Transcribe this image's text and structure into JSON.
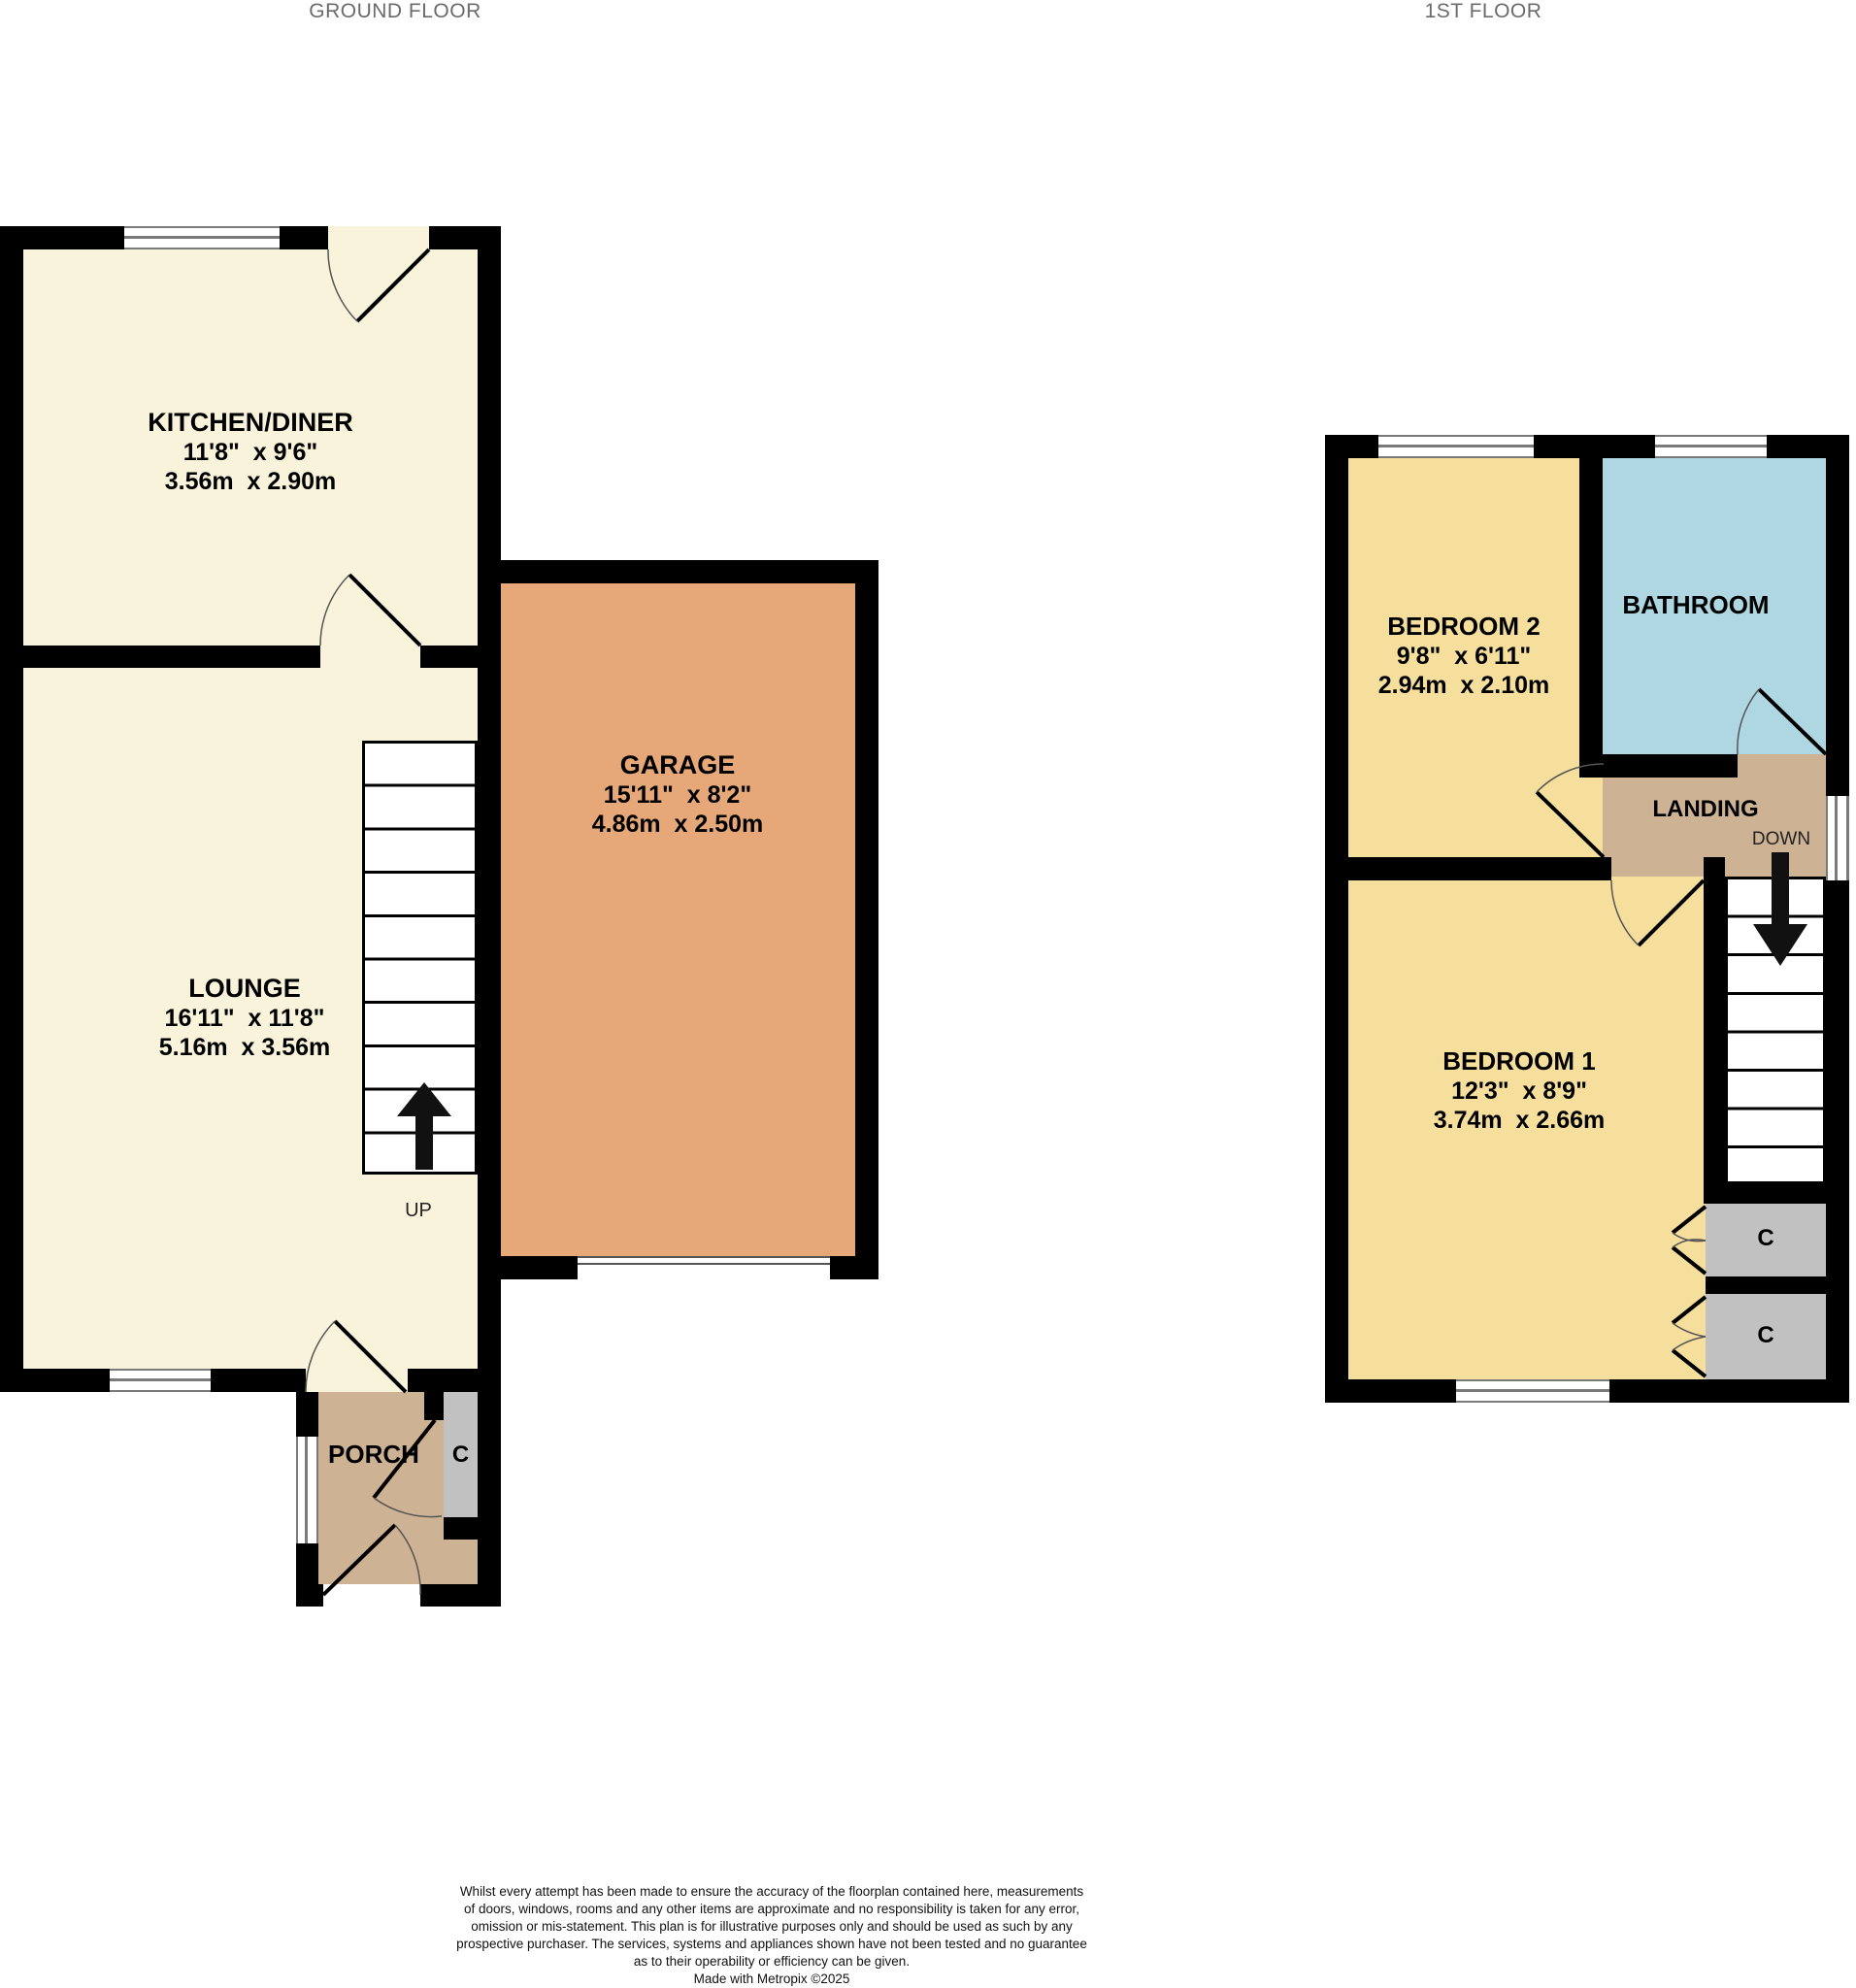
{
  "floors": {
    "ground": {
      "title": "GROUND FLOOR",
      "rooms": {
        "kitchen": {
          "name": "KITCHEN/DINER",
          "imperial": "11'8\"  x 9'6\"",
          "metric": "3.56m  x 2.90m"
        },
        "lounge": {
          "name": "LOUNGE",
          "imperial": "16'11\"  x 11'8\"",
          "metric": "5.16m  x 3.56m"
        },
        "garage": {
          "name": "GARAGE",
          "imperial": "15'11\"  x 8'2\"",
          "metric": "4.86m  x 2.50m"
        },
        "porch": {
          "name": "PORCH"
        },
        "cupboard": {
          "name": "C"
        }
      },
      "stairs_label": "UP"
    },
    "first": {
      "title": "1ST FLOOR",
      "rooms": {
        "bedroom2": {
          "name": "BEDROOM 2",
          "imperial": "9'8\"  x 6'11\"",
          "metric": "2.94m  x 2.10m"
        },
        "bathroom": {
          "name": "BATHROOM"
        },
        "landing": {
          "name": "LANDING"
        },
        "bedroom1": {
          "name": "BEDROOM 1",
          "imperial": "12'3\"  x 8'9\"",
          "metric": "3.74m  x 2.66m"
        },
        "cupboard1": {
          "name": "C"
        },
        "cupboard2": {
          "name": "C"
        }
      },
      "stairs_label": "DOWN"
    }
  },
  "colors": {
    "cream": "#FAF3DB",
    "garage": "#E6A878",
    "porch": "#CDB294",
    "landing": "#CDB294",
    "bedroom": "#F6DF9D",
    "bathroom": "#AED7E1",
    "cupboard": "#C2C1C1",
    "wall": "#000000"
  },
  "footer": {
    "lines": [
      "Whilst every attempt has been made to ensure the accuracy of the floorplan contained here, measurements",
      "of doors, windows, rooms and any other items are approximate and no responsibility is taken for any error,",
      "omission or mis-statement. This plan is for illustrative purposes only and should be used as such by any",
      "prospective purchaser. The services, systems and appliances shown have not been tested and no guarantee",
      "as to their operability or efficiency can be given.",
      "Made with Metropix ©2025"
    ]
  }
}
